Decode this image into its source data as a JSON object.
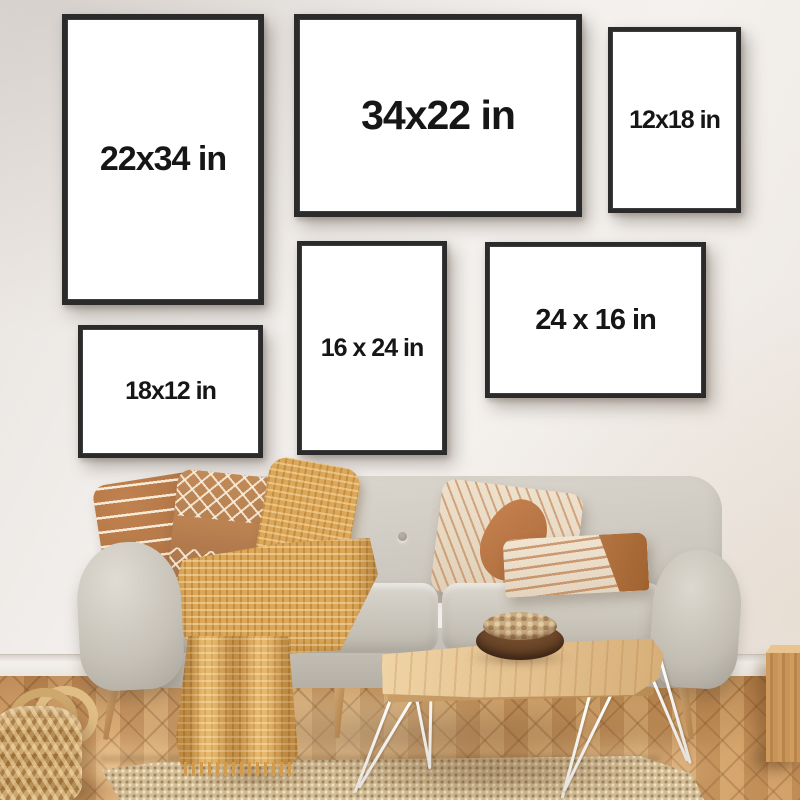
{
  "frames": [
    {
      "label": "22x34 in",
      "orientation": "portrait"
    },
    {
      "label": "34x22 in",
      "orientation": "landscape"
    },
    {
      "label": "12x18 in",
      "orientation": "portrait"
    },
    {
      "label": "16 x 24 in",
      "orientation": "portrait"
    },
    {
      "label": "24 x 16 in",
      "orientation": "landscape"
    },
    {
      "label": "18x12 in",
      "orientation": "landscape"
    }
  ],
  "colors": {
    "wall": "#f1eeea",
    "frame_border": "#2b2b2b",
    "frame_mat": "#ffffff",
    "label_text": "#161616",
    "sofa_fabric": "#cfcac1",
    "pillow_terracotta": "#b97a4c",
    "pillow_cream": "#ecdfca",
    "throw_blanket": "#dca758",
    "wood_floor": "#d09a60",
    "rug": "#d3bd96",
    "table_wood": "#e8c795",
    "bowl": "#5e3c22",
    "basket": "#c3995d",
    "hairpin_leg": "#f5f4f1"
  }
}
